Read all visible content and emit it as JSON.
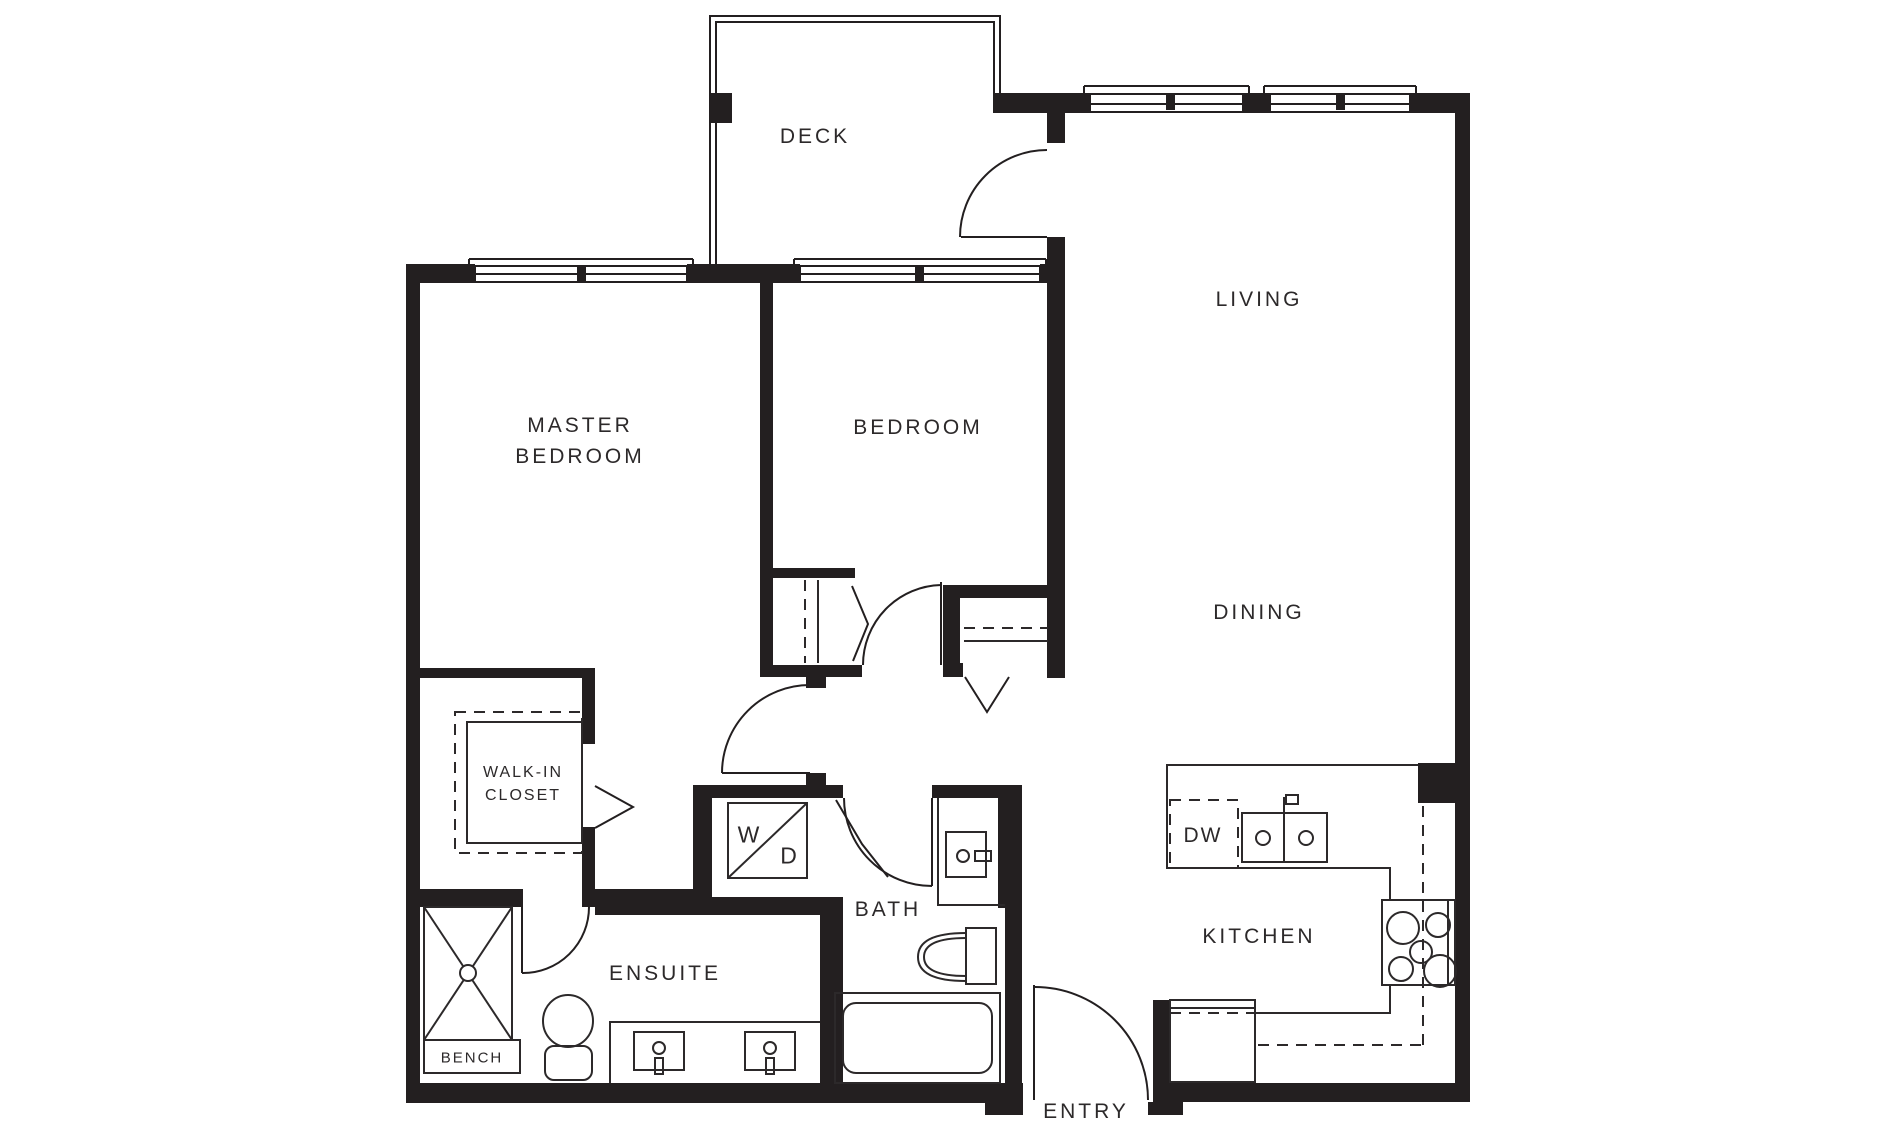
{
  "title": "Two bedroom apartment floor plan",
  "colors": {
    "wall": "#231f20",
    "line": "#2c292a",
    "background": "#ffffff",
    "text": "#2c292a"
  },
  "rooms": {
    "deck": {
      "label": "DECK"
    },
    "living": {
      "label": "LIVING"
    },
    "dining": {
      "label": "DINING"
    },
    "kitchen": {
      "label": "KITCHEN"
    },
    "master_bedroom": {
      "line1": "MASTER",
      "line2": "BEDROOM"
    },
    "bedroom": {
      "label": "BEDROOM"
    },
    "walk_in_closet": {
      "line1": "WALK-IN",
      "line2": "CLOSET"
    },
    "ensuite": {
      "label": "ENSUITE"
    },
    "bath": {
      "label": "BATH"
    },
    "entry": {
      "label": "ENTRY"
    }
  },
  "fixtures": {
    "bench": {
      "label": "BENCH"
    },
    "dishwasher": {
      "label": "DW"
    },
    "washer": {
      "label": "W"
    },
    "dryer": {
      "label": "D"
    }
  }
}
